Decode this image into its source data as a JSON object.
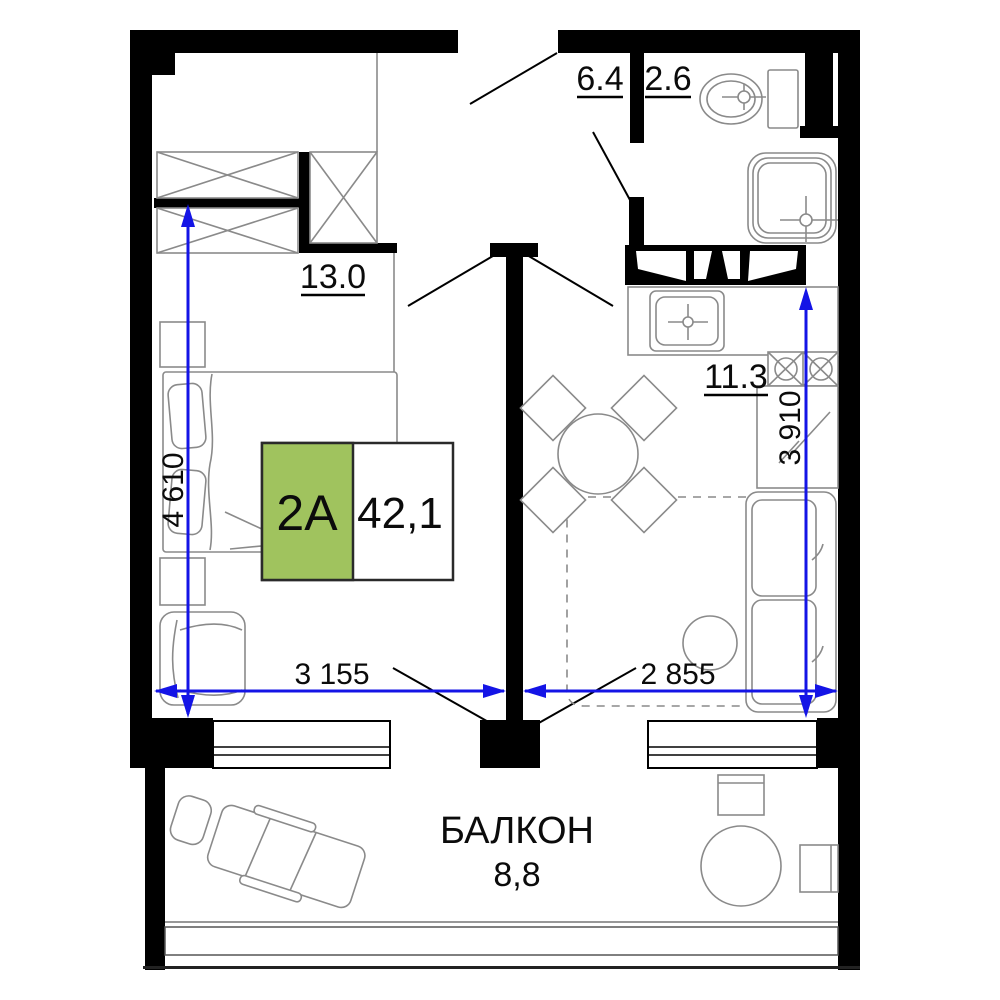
{
  "plan": {
    "unit_box": {
      "unit_label": "2A",
      "total_area": "42,1",
      "green_color": "#a0c35e"
    },
    "rooms": {
      "hallway": {
        "area": "6.4"
      },
      "bathroom": {
        "area": "2.6"
      },
      "bedroom": {
        "area": "13.0"
      },
      "kitchen_living": {
        "area": "11.3"
      },
      "balcony": {
        "name": "БАЛКОН",
        "area": "8,8"
      }
    },
    "dimensions": {
      "color": "#1414e6",
      "bedroom_width": "3 155",
      "living_width": "2 855",
      "bedroom_depth": "4 610",
      "kitchen_depth": "3 910"
    }
  }
}
